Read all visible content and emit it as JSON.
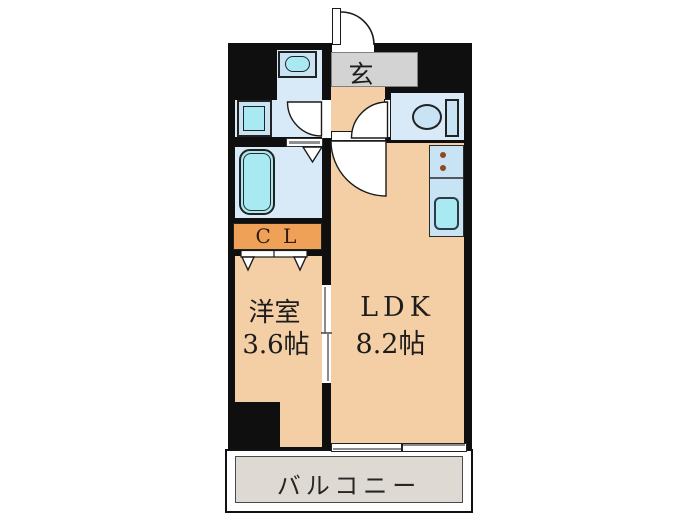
{
  "plan": {
    "type": "apartment-floor-plan",
    "rooms": {
      "genkan": {
        "label": "玄"
      },
      "closet": {
        "label": "C L"
      },
      "western_room": {
        "name": "洋室",
        "size": "3.6帖"
      },
      "ldk": {
        "name": "LDK",
        "size": "8.2帖"
      },
      "balcony": {
        "label": "バルコニー"
      }
    },
    "icons": [
      "entrance-door-swing",
      "washroom-door-swing",
      "toilet-door-swing",
      "ldk-door-swing",
      "bathtub",
      "washbasin",
      "washing-machine",
      "toilet",
      "kitchen-sink",
      "stove-burners",
      "folding-door-bathroom",
      "folding-door-closet",
      "sliding-door",
      "sliding-window"
    ],
    "colors": {
      "wall": "#0f0f0f",
      "room_beige": "#f4cea5",
      "water_area_blue": "#d8eaf7",
      "fixture_blue": "#c8e3f4",
      "fixture_cyan": "#a9e9f1",
      "closet_orange": "#f0a158",
      "genkan_gray": "#d3d3d3",
      "balcony_gray": "#dedad3",
      "burner_brown": "#8d4a1f"
    }
  }
}
